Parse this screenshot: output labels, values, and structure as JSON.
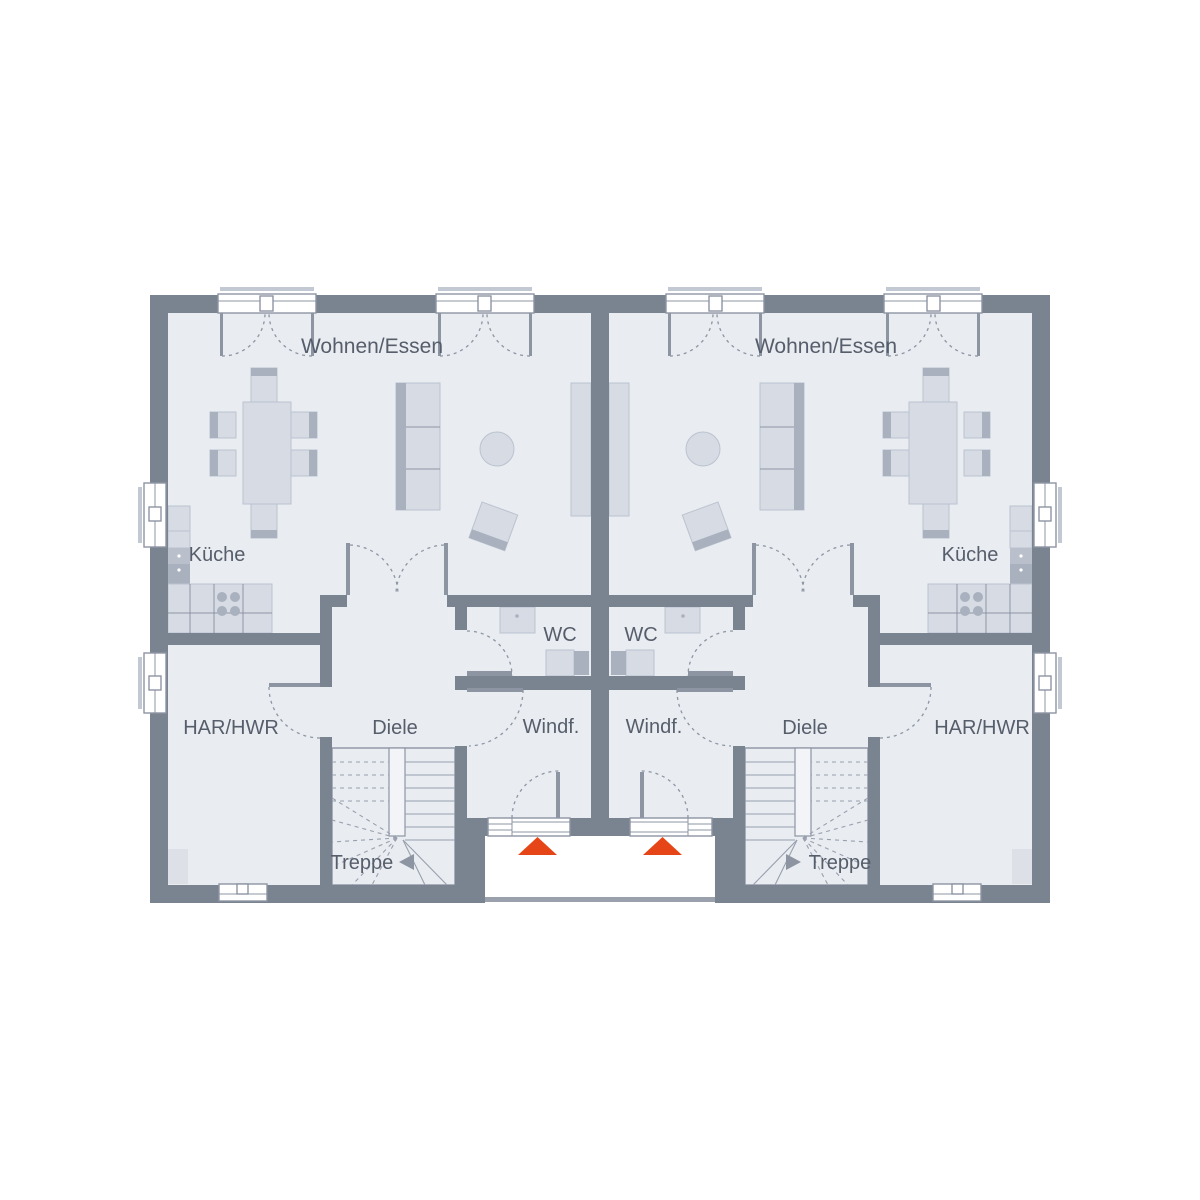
{
  "rooms": {
    "left_unit": {
      "living": "Wohnen/Essen",
      "kitchen": "Küche",
      "utility": "HAR/HWR",
      "hallway": "Diele",
      "wc": "WC",
      "vestibule": "Windf.",
      "stairs": "Treppe"
    },
    "right_unit": {
      "living": "Wohnen/Essen",
      "kitchen": "Küche",
      "utility": "HAR/HWR",
      "hallway": "Diele",
      "wc": "WC",
      "vestibule": "Windf.",
      "stairs": "Treppe"
    }
  },
  "colors": {
    "wall": "#7a8390",
    "floor": "#e9ecf1",
    "furniture": "#d6dbe4",
    "furniture_edge": "#bcc3cf",
    "furniture_dark": "#a9b1bf",
    "appliance": "#b9c0cb",
    "line": "#8d95a3",
    "tread": "#98a0ad",
    "text": "#565e6b",
    "accent_red": "#e64517",
    "outline_light": "#c3c9d3",
    "porch_edge": "#9aa1ac",
    "equipment": "#dde0e7",
    "void_fill": "#f2f4f8"
  }
}
